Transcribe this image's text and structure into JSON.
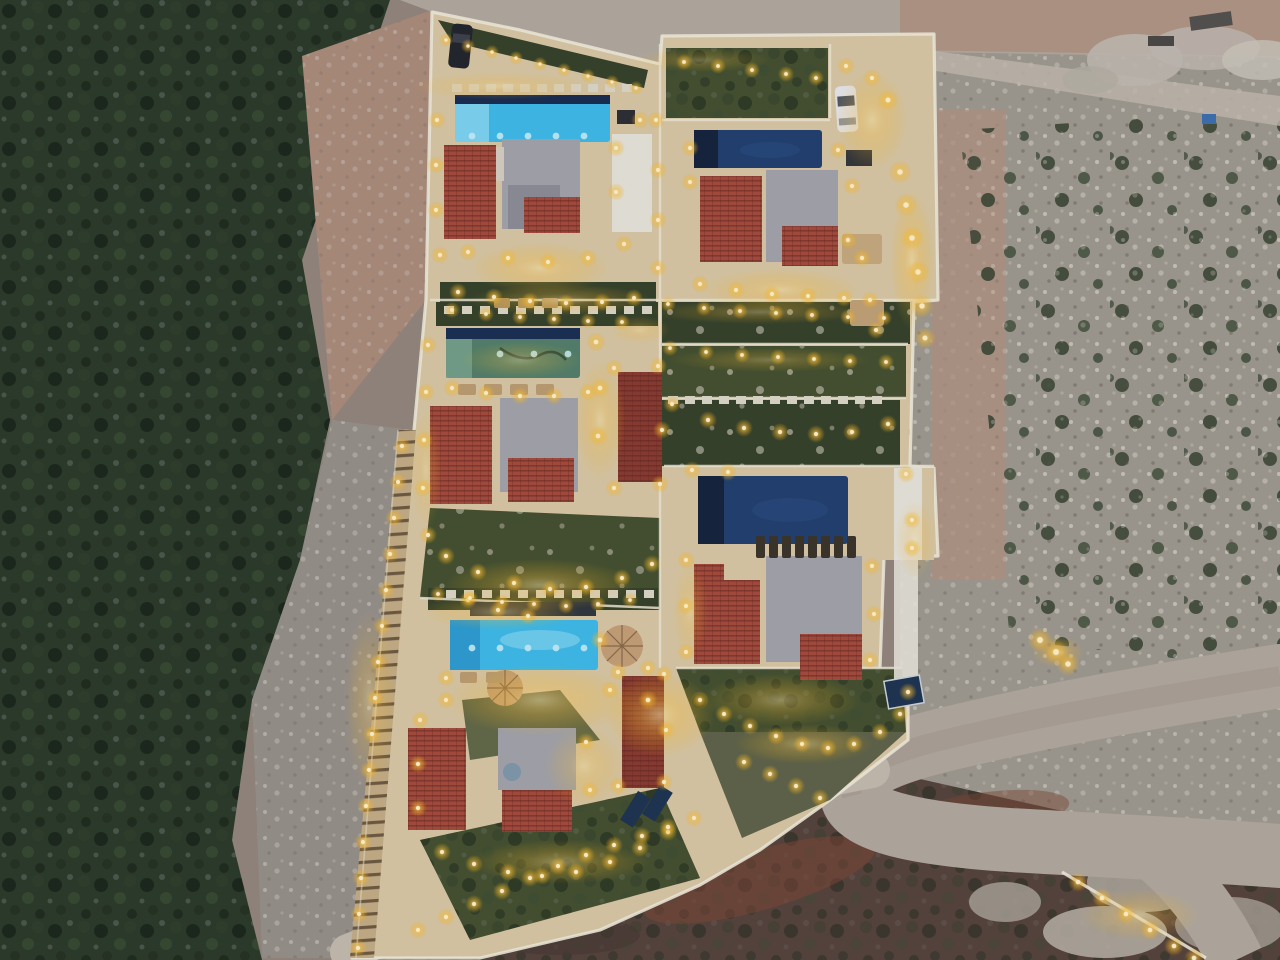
{
  "image": {
    "title": "Aerial dusk drone view of an illuminated hillside villa complex with swimming pools",
    "width": 1280,
    "height": 960
  },
  "colors": {
    "terrain_base": "#94867c",
    "veg_base": "#2c3a28",
    "veg_dark": "#1a2517",
    "rubble": "#a09a8f",
    "soil_pink": "#ad8d7b",
    "soil_pink2": "#b3937f",
    "road": "#b4aa9e",
    "road_lit": "#c6bcae",
    "deck": "#dbc9a4",
    "deck_warm": "#f0d595",
    "wall": "#f2ead6",
    "garden": "#46512f",
    "garden_dark": "#37422a",
    "roof_red": "#a74b3b",
    "roof_red_dark": "#8c3b30",
    "roof_gray": "#a4a4aa",
    "roof_gray_dark": "#8e8e95",
    "terrace_white": "#e9e5da",
    "pool_cyan": "#3fbbe9",
    "pool_cyan_light": "#8fdcf5",
    "pool_navy": "#23406e",
    "pool_navy_dark": "#16233c",
    "pool_green": "#55806a",
    "pool_green_light": "#7aa68c",
    "light_core": "#fff3c8",
    "light_glow": "#ffb91e",
    "slope": "#57433a",
    "slope_red": "#7e4734",
    "boulder": "#c2bab0",
    "car_white": "#e8e8ea",
    "car_dark": "#23262b",
    "solar": "#1f3450",
    "parasol": "#c8a176",
    "lounger_dark": "#3c3427",
    "lounger_tan": "#bd9e70",
    "stair_tread": "#c7ae85",
    "dusk_tint": "#1c2a4a"
  },
  "scene": {
    "lights": [
      [
        446,
        40,
        0.8
      ],
      [
        468,
        46,
        0.8
      ],
      [
        492,
        52,
        0.8
      ],
      [
        516,
        58,
        0.8
      ],
      [
        540,
        64,
        0.8
      ],
      [
        564,
        70,
        0.8
      ],
      [
        588,
        76,
        0.8
      ],
      [
        612,
        82,
        0.8
      ],
      [
        636,
        88,
        0.8
      ],
      [
        437,
        120,
        1
      ],
      [
        436,
        165,
        1
      ],
      [
        436,
        210,
        1
      ],
      [
        440,
        255,
        1
      ],
      [
        616,
        148,
        1
      ],
      [
        616,
        192,
        1
      ],
      [
        640,
        120,
        1
      ],
      [
        468,
        252,
        1
      ],
      [
        508,
        258,
        1
      ],
      [
        548,
        262,
        1
      ],
      [
        588,
        258,
        1
      ],
      [
        624,
        244,
        1
      ],
      [
        458,
        292,
        1
      ],
      [
        494,
        297,
        1
      ],
      [
        530,
        301,
        1
      ],
      [
        566,
        303,
        1
      ],
      [
        602,
        302,
        1
      ],
      [
        634,
        298,
        1
      ],
      [
        656,
        120,
        1
      ],
      [
        658,
        170,
        1
      ],
      [
        658,
        220,
        1
      ],
      [
        658,
        268,
        1
      ],
      [
        684,
        62,
        0.9
      ],
      [
        718,
        66,
        0.9
      ],
      [
        752,
        70,
        0.9
      ],
      [
        786,
        74,
        0.9
      ],
      [
        816,
        78,
        0.9
      ],
      [
        846,
        66,
        1
      ],
      [
        872,
        78,
        1
      ],
      [
        888,
        100,
        1.2
      ],
      [
        900,
        172,
        1.3
      ],
      [
        906,
        205,
        1.3
      ],
      [
        912,
        238,
        1.3
      ],
      [
        918,
        272,
        1.3
      ],
      [
        922,
        306,
        1.3
      ],
      [
        925,
        338,
        1.2
      ],
      [
        690,
        148,
        1
      ],
      [
        690,
        182,
        1
      ],
      [
        838,
        150,
        1
      ],
      [
        852,
        186,
        1
      ],
      [
        848,
        240,
        1
      ],
      [
        862,
        258,
        1
      ],
      [
        870,
        300,
        1
      ],
      [
        876,
        330,
        1
      ],
      [
        700,
        284,
        1
      ],
      [
        736,
        290,
        1
      ],
      [
        772,
        294,
        1
      ],
      [
        808,
        296,
        1
      ],
      [
        844,
        298,
        1
      ],
      [
        452,
        310,
        0.9
      ],
      [
        486,
        314,
        0.9
      ],
      [
        520,
        317,
        0.9
      ],
      [
        554,
        319,
        0.9
      ],
      [
        588,
        321,
        0.9
      ],
      [
        622,
        322,
        0.9
      ],
      [
        452,
        388,
        1
      ],
      [
        486,
        393,
        1
      ],
      [
        520,
        396,
        1
      ],
      [
        554,
        396,
        1
      ],
      [
        588,
        392,
        1
      ],
      [
        428,
        345,
        1
      ],
      [
        426,
        392,
        1
      ],
      [
        424,
        440,
        1
      ],
      [
        423,
        488,
        1
      ],
      [
        428,
        535,
        1
      ],
      [
        614,
        368,
        1
      ],
      [
        658,
        366,
        1
      ],
      [
        662,
        430,
        1
      ],
      [
        660,
        484,
        1
      ],
      [
        614,
        488,
        1
      ],
      [
        596,
        342,
        1.1
      ],
      [
        600,
        388,
        1.1
      ],
      [
        598,
        436,
        1.1
      ],
      [
        446,
        556,
        1
      ],
      [
        478,
        572,
        1
      ],
      [
        514,
        583,
        1
      ],
      [
        550,
        589,
        1
      ],
      [
        586,
        587,
        1
      ],
      [
        622,
        578,
        1
      ],
      [
        652,
        564,
        1
      ],
      [
        468,
        600,
        1
      ],
      [
        498,
        610,
        1
      ],
      [
        528,
        616,
        1
      ],
      [
        668,
        304,
        0.9
      ],
      [
        704,
        308,
        0.9
      ],
      [
        740,
        311,
        0.9
      ],
      [
        776,
        313,
        0.9
      ],
      [
        812,
        315,
        0.9
      ],
      [
        848,
        317,
        0.9
      ],
      [
        884,
        318,
        0.9
      ],
      [
        670,
        348,
        0.9
      ],
      [
        706,
        352,
        0.9
      ],
      [
        742,
        355,
        0.9
      ],
      [
        778,
        357,
        0.9
      ],
      [
        814,
        359,
        0.9
      ],
      [
        850,
        361,
        0.9
      ],
      [
        886,
        362,
        0.9
      ],
      [
        672,
        404,
        1
      ],
      [
        708,
        420,
        1
      ],
      [
        744,
        428,
        1
      ],
      [
        780,
        432,
        1
      ],
      [
        816,
        434,
        1
      ],
      [
        852,
        432,
        1
      ],
      [
        888,
        424,
        1
      ],
      [
        692,
        470,
        1
      ],
      [
        728,
        472,
        1
      ],
      [
        906,
        474,
        1
      ],
      [
        912,
        520,
        1
      ],
      [
        912,
        548,
        1
      ],
      [
        686,
        560,
        1
      ],
      [
        686,
        606,
        1
      ],
      [
        686,
        652,
        1
      ],
      [
        872,
        566,
        1
      ],
      [
        874,
        614,
        1
      ],
      [
        870,
        660,
        1
      ],
      [
        700,
        700,
        1
      ],
      [
        724,
        714,
        1
      ],
      [
        750,
        726,
        1
      ],
      [
        776,
        736,
        1
      ],
      [
        802,
        744,
        1
      ],
      [
        828,
        748,
        1
      ],
      [
        854,
        744,
        1
      ],
      [
        880,
        732,
        1
      ],
      [
        900,
        714,
        1
      ],
      [
        908,
        692,
        1
      ],
      [
        744,
        762,
        1
      ],
      [
        770,
        774,
        1
      ],
      [
        796,
        786,
        1
      ],
      [
        820,
        798,
        1
      ],
      [
        438,
        594,
        0.9
      ],
      [
        470,
        598,
        0.9
      ],
      [
        502,
        602,
        0.9
      ],
      [
        534,
        604,
        0.9
      ],
      [
        566,
        606,
        0.9
      ],
      [
        598,
        604,
        0.9
      ],
      [
        630,
        600,
        0.9
      ],
      [
        446,
        678,
        1
      ],
      [
        446,
        700,
        1
      ],
      [
        610,
        690,
        1
      ],
      [
        648,
        668,
        1
      ],
      [
        600,
        640,
        1.1
      ],
      [
        648,
        700,
        1.1
      ],
      [
        420,
        720,
        1
      ],
      [
        418,
        764,
        1
      ],
      [
        418,
        808,
        1
      ],
      [
        586,
        742,
        1
      ],
      [
        590,
        790,
        1
      ],
      [
        442,
        852,
        1
      ],
      [
        474,
        864,
        1
      ],
      [
        508,
        872,
        1
      ],
      [
        542,
        876,
        1
      ],
      [
        576,
        872,
        1
      ],
      [
        610,
        862,
        1
      ],
      [
        640,
        848,
        1
      ],
      [
        668,
        832,
        1
      ],
      [
        618,
        672,
        1
      ],
      [
        664,
        674,
        1
      ],
      [
        666,
        730,
        1
      ],
      [
        664,
        782,
        1
      ],
      [
        618,
        786,
        1
      ],
      [
        402,
        446,
        1
      ],
      [
        398,
        482,
        1
      ],
      [
        394,
        518,
        1
      ],
      [
        390,
        554,
        1
      ],
      [
        386,
        590,
        1
      ],
      [
        382,
        626,
        1
      ],
      [
        378,
        662,
        1
      ],
      [
        375,
        698,
        1
      ],
      [
        372,
        734,
        1
      ],
      [
        369,
        770,
        1
      ],
      [
        366,
        806,
        1
      ],
      [
        363,
        842,
        1
      ],
      [
        361,
        878,
        1
      ],
      [
        359,
        914,
        1
      ],
      [
        358,
        948,
        1
      ],
      [
        418,
        930,
        1
      ],
      [
        446,
        917,
        1
      ],
      [
        474,
        904,
        1
      ],
      [
        502,
        891,
        1
      ],
      [
        530,
        878,
        1
      ],
      [
        558,
        866,
        1
      ],
      [
        586,
        855,
        1
      ],
      [
        614,
        845,
        1
      ],
      [
        642,
        836,
        1
      ],
      [
        668,
        827,
        1
      ],
      [
        694,
        818,
        1
      ],
      [
        1040,
        640,
        1.4
      ],
      [
        1056,
        652,
        1.4
      ],
      [
        1068,
        664,
        1.3
      ],
      [
        1078,
        882,
        1.1
      ],
      [
        1102,
        898,
        1.1
      ],
      [
        1126,
        914,
        1.1
      ],
      [
        1150,
        930,
        1.1
      ],
      [
        1174,
        946,
        1.1
      ],
      [
        1194,
        958,
        1.1
      ]
    ],
    "glows": [
      [
        540,
        268,
        70,
        26,
        0.55
      ],
      [
        560,
        300,
        90,
        16,
        0.5
      ],
      [
        780,
        290,
        80,
        22,
        0.5
      ],
      [
        872,
        120,
        36,
        50,
        0.55
      ],
      [
        912,
        260,
        22,
        70,
        0.6
      ],
      [
        520,
        360,
        60,
        18,
        0.4
      ],
      [
        600,
        420,
        26,
        60,
        0.5
      ],
      [
        540,
        585,
        95,
        26,
        0.55
      ],
      [
        500,
        612,
        80,
        18,
        0.5
      ],
      [
        540,
        700,
        95,
        36,
        0.6
      ],
      [
        660,
        715,
        55,
        42,
        0.65
      ],
      [
        370,
        700,
        26,
        90,
        0.45
      ],
      [
        780,
        700,
        80,
        26,
        0.5
      ],
      [
        804,
        744,
        70,
        20,
        0.5
      ],
      [
        560,
        862,
        90,
        22,
        0.5
      ],
      [
        640,
        330,
        30,
        14,
        0.4
      ],
      [
        915,
        540,
        20,
        40,
        0.4
      ],
      [
        690,
        610,
        18,
        50,
        0.4
      ],
      [
        426,
        470,
        16,
        60,
        0.35
      ],
      [
        584,
        766,
        40,
        40,
        0.45
      ],
      [
        1058,
        652,
        26,
        16,
        0.6
      ],
      [
        1140,
        915,
        60,
        26,
        0.5
      ],
      [
        500,
        86,
        90,
        14,
        0.4
      ],
      [
        760,
        312,
        110,
        12,
        0.4
      ],
      [
        770,
        360,
        100,
        12,
        0.35
      ],
      [
        700,
        60,
        70,
        12,
        0.35
      ]
    ],
    "paver_rows": [
      {
        "x": 452,
        "y": 84,
        "step": 17,
        "count": 11,
        "w": 10,
        "h": 8
      },
      {
        "x": 444,
        "y": 306,
        "step": 18,
        "count": 12,
        "w": 10,
        "h": 8
      },
      {
        "x": 668,
        "y": 396,
        "step": 17,
        "count": 13,
        "w": 10,
        "h": 8
      },
      {
        "x": 446,
        "y": 590,
        "step": 18,
        "count": 12,
        "w": 10,
        "h": 8
      }
    ],
    "lounger_rows": [
      {
        "x": 756,
        "y": 536,
        "step": 13,
        "count": 8,
        "w": 9,
        "h": 22,
        "color": "#3c3427"
      },
      {
        "x": 458,
        "y": 384,
        "step": 26,
        "count": 4,
        "w": 18,
        "h": 11,
        "color": "#bd9e70"
      },
      {
        "x": 460,
        "y": 672,
        "step": 26,
        "count": 2,
        "w": 17,
        "h": 11,
        "color": "#bd9e70"
      },
      {
        "x": 494,
        "y": 298,
        "step": 24,
        "count": 3,
        "w": 16,
        "h": 10,
        "color": "#b4945f"
      }
    ],
    "pool_spot_rows": [
      {
        "x": 472,
        "y": 136,
        "step": 28,
        "count": 5
      },
      {
        "x": 472,
        "y": 648,
        "step": 28,
        "count": 5
      },
      {
        "x": 500,
        "y": 354,
        "step": 34,
        "count": 3
      }
    ]
  }
}
